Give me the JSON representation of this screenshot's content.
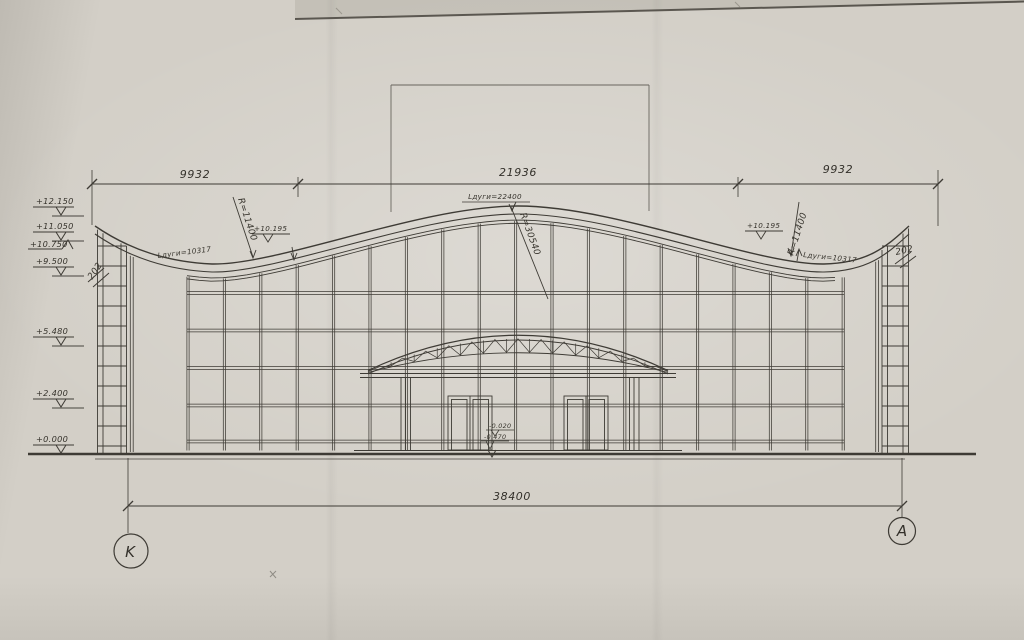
{
  "drawing": {
    "dimensions": {
      "top_left": "9932",
      "top_center": "21936",
      "top_right": "9932",
      "overall": "38400"
    },
    "axes": {
      "left": "K",
      "right": "A"
    },
    "levels_left": [
      "+12.150",
      "+11.050",
      "+10.750",
      "+9.500",
      "+5.480",
      "+2.400",
      "+0.000"
    ],
    "roof": {
      "level_left": "+10.195",
      "level_right": "+10.195",
      "radius_left": "R=11400",
      "radius_center": "R=30540",
      "radius_right": "R=11400",
      "arc_left": "Lдуги=10317",
      "arc_center": "Lдуги=22400",
      "arc_right": "Lдуги=10317"
    },
    "edge_left": "202",
    "edge_right": "202",
    "entrance_levels": {
      "upper": "-0.020",
      "lower": "-0.470"
    }
  }
}
